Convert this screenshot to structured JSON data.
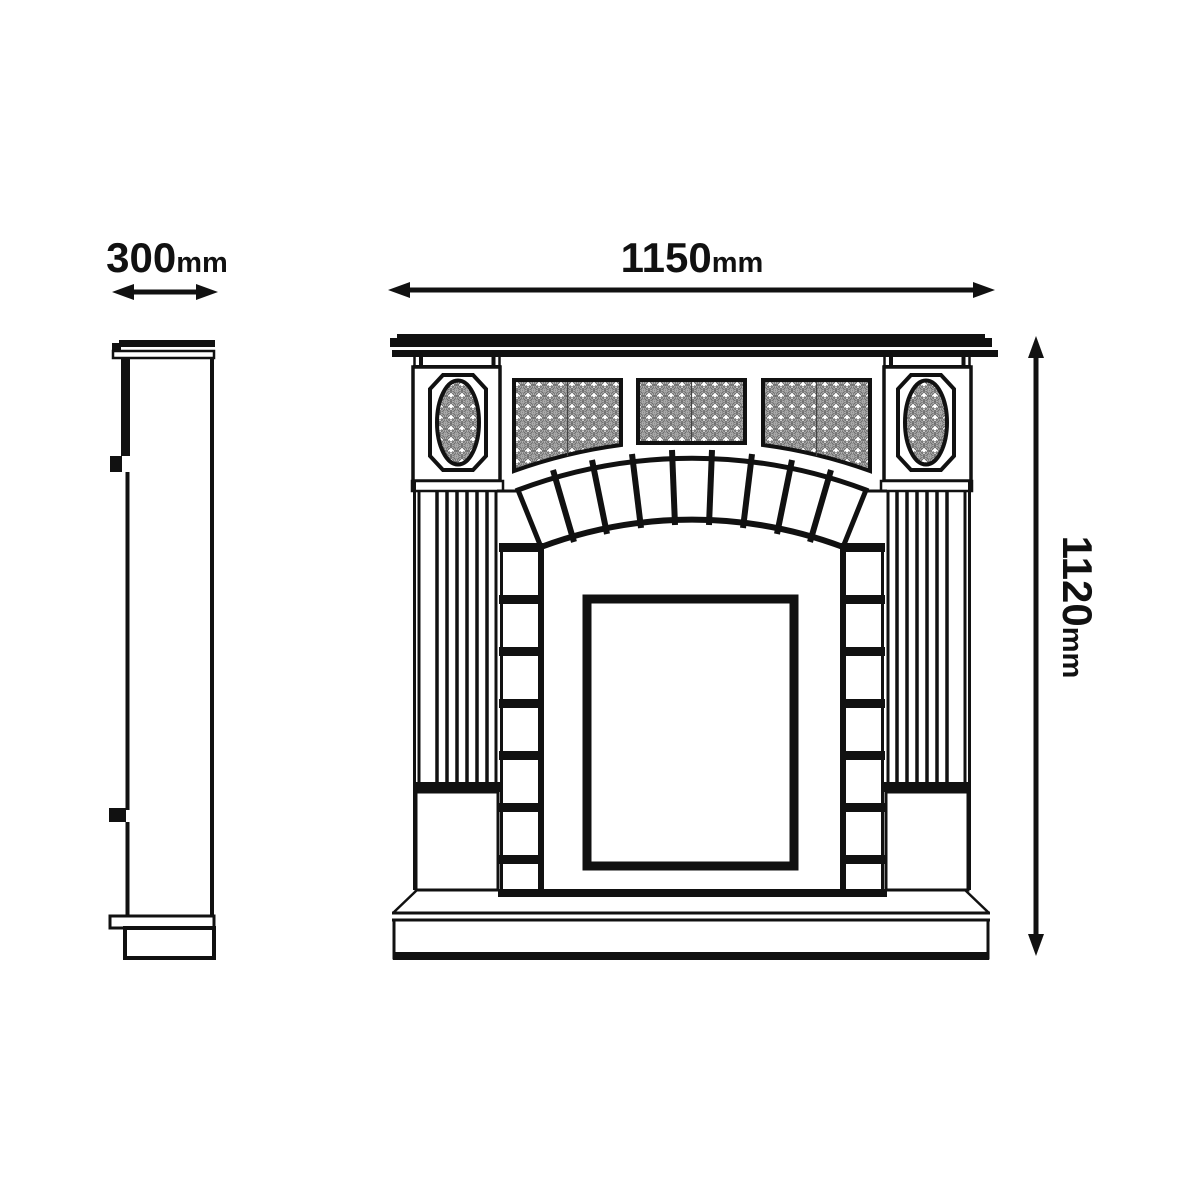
{
  "diagram": {
    "type": "dimensioned technical drawing",
    "subject": "fireplace mantel surround, side and front elevations",
    "views": [
      "side-elevation",
      "front-elevation"
    ]
  },
  "labels": {
    "depth": {
      "value": "300",
      "unit": "mm"
    },
    "width": {
      "value": "1150",
      "unit": "mm"
    },
    "height": {
      "value": "1120",
      "unit": "mm"
    }
  },
  "colors": {
    "line": "#111111",
    "background": "#ffffff",
    "pattern": "#666666"
  }
}
